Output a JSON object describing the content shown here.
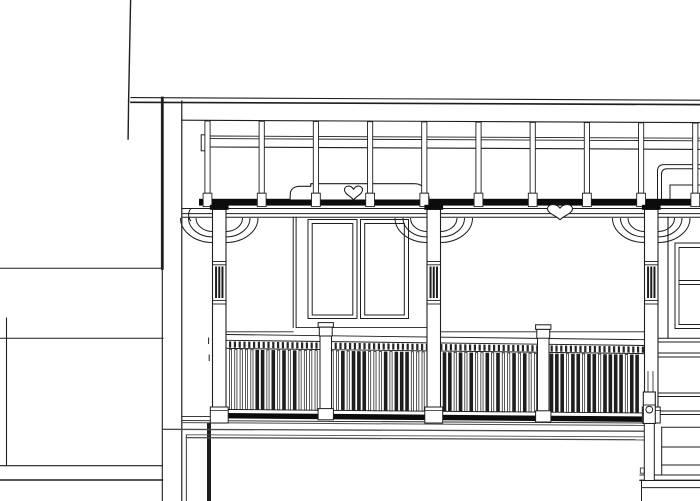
{
  "drawing": {
    "canvas": {
      "w": 700,
      "h": 501
    },
    "colors": {
      "paper": "#ffffff",
      "ink": "#1e1e1e",
      "dark": "#0c0c0c",
      "gray": "#4d4d4d",
      "dentil": "#262626"
    },
    "left_wall": {
      "lines": [
        [
          0,
          268.3,
          162,
          268.3,
          1.0
        ],
        [
          0,
          338.3,
          163,
          338.3,
          1.0
        ],
        [
          0,
          465.7,
          162.5,
          465.7,
          1.1
        ],
        [
          0,
          480,
          162.5,
          480,
          1.4
        ],
        [
          6.5,
          318,
          6.5,
          465.7,
          1.1
        ],
        [
          162.3,
          98,
          162.3,
          268.3,
          2.8
        ],
        [
          162.3,
          268.3,
          162.3,
          501,
          1.1
        ],
        [
          181.8,
          101,
          181.8,
          501,
          1.2
        ],
        [
          186.3,
          435,
          186.3,
          501,
          0.9
        ],
        [
          209,
          424.5,
          209,
          501,
          4.0
        ]
      ]
    },
    "roof": {
      "lines": [
        [
          130.6,
          0,
          128.6,
          101,
          1.4
        ],
        [
          128.6,
          101,
          128.1,
          139,
          1.4
        ],
        [
          131,
          97.6,
          700,
          100.2,
          1.1
        ],
        [
          131,
          102.3,
          700,
          104.6,
          1.7
        ]
      ]
    },
    "wall": {
      "lines": [
        [
          293.2,
          217.3,
          293.2,
          327.6,
          1.0
        ],
        [
          296.1,
          217.3,
          296.1,
          327.6,
          1.0
        ],
        [
          296.1,
          327.6,
          427,
          327.6,
          0.9
        ],
        [
          227,
          331.8,
          293.2,
          331.8,
          0.9
        ],
        [
          440.5,
          331.8,
          644.5,
          331.8,
          0.9
        ],
        [
          668,
          217.3,
          668,
          338.2,
          1.1
        ]
      ],
      "window_rects": [
        [
          308,
          219.5,
          49,
          99
        ],
        [
          312.2,
          223.5,
          40.6,
          91.5
        ],
        [
          360.5,
          219.5,
          48,
          99
        ],
        [
          364.7,
          223.5,
          39.6,
          91.5
        ]
      ],
      "right_window_lines": [
        [
          675,
          243,
          675,
          328.5,
          1.0
        ],
        [
          679,
          247.5,
          679,
          324.5,
          0.9
        ],
        [
          675,
          243,
          700,
          243,
          1.0
        ],
        [
          679,
          247.5,
          700,
          247.5,
          0.9
        ],
        [
          679,
          280.5,
          700,
          280.5,
          0.9
        ],
        [
          679,
          284.5,
          700,
          284.5,
          0.9
        ],
        [
          679,
          324.5,
          700,
          324.5,
          0.9
        ],
        [
          675,
          328.5,
          700,
          328.5,
          1.0
        ]
      ]
    },
    "pergola": {
      "top_line": [
        181.8,
        120.2,
        700,
        122.6,
        1.1
      ],
      "rail_lines": [
        [
          208.3,
          136,
          700,
          138.2,
          0.9
        ],
        [
          208.3,
          138.6,
          700,
          140.8,
          0.9
        ],
        [
          208.3,
          147,
          700,
          149.4,
          1.1
        ]
      ],
      "end_cap": [
        201.2,
        134.8,
        7.2,
        16
      ],
      "beam_band": [
        199,
        198.8,
        501,
        6.8
      ],
      "beam_lines": [
        [
          181.8,
          208.5,
          700,
          208.5,
          1.0
        ],
        [
          181.8,
          213.6,
          700,
          213.6,
          1.0
        ],
        [
          181.8,
          217.3,
          700,
          217.3,
          1.0
        ]
      ],
      "post_centers": [
        207.5,
        261.7,
        315.9,
        370.1,
        424.3,
        478.5,
        532.7,
        586.9,
        641.1,
        695.3
      ],
      "post": {
        "w": 5.2,
        "top_y0": 120.9,
        "top_slope": 2.2,
        "body_bottom": 193.2,
        "foot_w": 8.8,
        "foot_bottom": 206.6
      }
    },
    "decor": {
      "silhouette": "M290,199.5 L290.4,192.6 C291.2,188.6 294.8,186.4 299.8,186.3 L310.8,186.3 L310.8,183.7 L414.6,183.7 C419.6,183.7 422.4,185.4 424.7,188.9 L427.2,192.9 C428.5,195.1 429.2,197.2 429.2,199.5",
      "hearts": [
        {
          "cx": 353.5,
          "y": 185.2,
          "w": 18,
          "h": 14.6
        },
        {
          "cx": 560,
          "y": 203.6,
          "w": 25,
          "h": 16.2
        }
      ],
      "right_corner_paths": [
        "M657.5,199 L657.5,171 Q657.5,164.6 664,164.6 L700,164.6",
        "M661.5,199 L661.5,174.6 Q661.5,168.8 667,168.8 L700,168.8"
      ],
      "right_corner_lines": [
        [
          670,
          185,
          700,
          185,
          1.0
        ],
        [
          670,
          185,
          670,
          199,
          1.0
        ]
      ],
      "wall_arc": "M190.9,208.5 Q186.3,214.6 190.9,221.2"
    },
    "corbels": {
      "spring_y": 218,
      "reach": [
        32,
        24,
        16.5
      ],
      "drop": [
        24.5,
        19,
        13.5
      ]
    },
    "columns": {
      "xs": [
        212.5,
        427,
        644.5
      ],
      "w": 13.5,
      "shaft_top": 209.3,
      "shaft_bottom": 423,
      "cap": {
        "dx": -2.6,
        "y": 204.8,
        "h": 5
      },
      "panel": {
        "line_ys": [
          261.5,
          264.8,
          300.4,
          304
        ],
        "stroke_top": 267.5,
        "stroke_bottom": 297,
        "offsets": [
          -3.2,
          0,
          3.2
        ],
        "stroke_w": 2
      },
      "foot": {
        "dx": -2.2,
        "y": 407,
        "h": 16,
        "line_dy": 3.4
      }
    },
    "newels": {
      "xs": [
        320,
        537.5
      ],
      "w": 11.5,
      "slope": [
        0.6,
        2.8
      ],
      "cap_slab": {
        "dx": -1.9,
        "y": 322,
        "h": 4.6
      },
      "cap_block": {
        "dx": -0.7,
        "y": 326.6,
        "h": 8.8
      },
      "shaft": {
        "top": 335.2,
        "bottom": 409.5
      },
      "foot": {
        "dx": -1.9,
        "y": 408,
        "h": 11.2
      }
    },
    "railing": {
      "x1": 227,
      "x2": 644.5,
      "top_slope": 5.2,
      "bottom_slope": 3.5,
      "top_lines_y": [
        334.5,
        340.3,
        348.4
      ],
      "bottom_line_y": 409.5,
      "band": {
        "y": 415.7,
        "w": 5.4
      },
      "under_lines": [
        [
          181.8,
          416.6,
          211,
          416.6,
          0.9
        ],
        [
          181.8,
          420.6,
          644.5,
          423,
          0.9
        ]
      ],
      "dentils": {
        "x0": 229,
        "step": 4.8,
        "n": 87,
        "w": 2.2,
        "y": 341.4,
        "h": 6.2
      },
      "balusters": {
        "x0": 230.5,
        "step": 5.35,
        "n": 77,
        "y1": 349.5,
        "y2": 409.5,
        "w": 2.2,
        "dark_w": 3.6,
        "dark": [
          5,
          6,
          8,
          10,
          12,
          21,
          23,
          24,
          25,
          29,
          31,
          32,
          33,
          40,
          41,
          43,
          45,
          48,
          50,
          53,
          55,
          60,
          61,
          62,
          64,
          65,
          67,
          68,
          70,
          71,
          72,
          73,
          75,
          76
        ]
      },
      "dashes": [
        [
          208.6,
          338,
          208.6,
          343.5,
          1.0
        ],
        [
          209.2,
          355,
          209.2,
          360.5,
          1.0
        ]
      ]
    },
    "deck": {
      "lines": [
        [
          181.8,
          422.6,
          643.5,
          425.4,
          1.0
        ],
        [
          163,
          429.3,
          643.5,
          431.2,
          1.3
        ],
        [
          186.3,
          434.8,
          643.5,
          436.8,
          0.9
        ],
        [
          186.3,
          437.6,
          643.5,
          439.8,
          1.3
        ]
      ]
    },
    "stairs": {
      "lines": [
        [
          658,
          338.2,
          700,
          338.2,
          1.0
        ],
        [
          658,
          342,
          700,
          342,
          1.0
        ],
        [
          658,
          353,
          700,
          353,
          1.0
        ],
        [
          658,
          357,
          700,
          357,
          1.0
        ],
        [
          658,
          393,
          700,
          393,
          1.0
        ],
        [
          658,
          396.5,
          700,
          396.5,
          1.0
        ],
        [
          658,
          411,
          700,
          411,
          1.0
        ],
        [
          658,
          414.5,
          700,
          414.5,
          1.0
        ],
        [
          661.7,
          427.3,
          700,
          427.3,
          1.0
        ],
        [
          661.7,
          447,
          700,
          447,
          1.0
        ],
        [
          661.7,
          465,
          700,
          465,
          1.0
        ],
        [
          640,
          475,
          700,
          475,
          1.0
        ],
        [
          640,
          480.3,
          700,
          480.3,
          1.3
        ],
        [
          641.5,
          487.6,
          700,
          487.6,
          1.0
        ],
        [
          661.7,
          427.3,
          661.7,
          475,
          1.0
        ],
        [
          641.5,
          480.3,
          641.5,
          501,
          1.0
        ]
      ],
      "newel": {
        "inner_lines": [
          [
            648,
            371.5,
            648,
            391.5,
            0.8
          ],
          [
            653,
            371.5,
            653,
            391.5,
            0.8
          ]
        ],
        "block": [
          643.3,
          392,
          12,
          31.5
        ],
        "block_line_y": 405,
        "circle": [
          649.3,
          409.6,
          3.4
        ],
        "post": [
          644.3,
          423.5,
          10,
          57
        ],
        "tick": [
          640.3,
          468,
          4,
          5.2
        ]
      }
    }
  }
}
